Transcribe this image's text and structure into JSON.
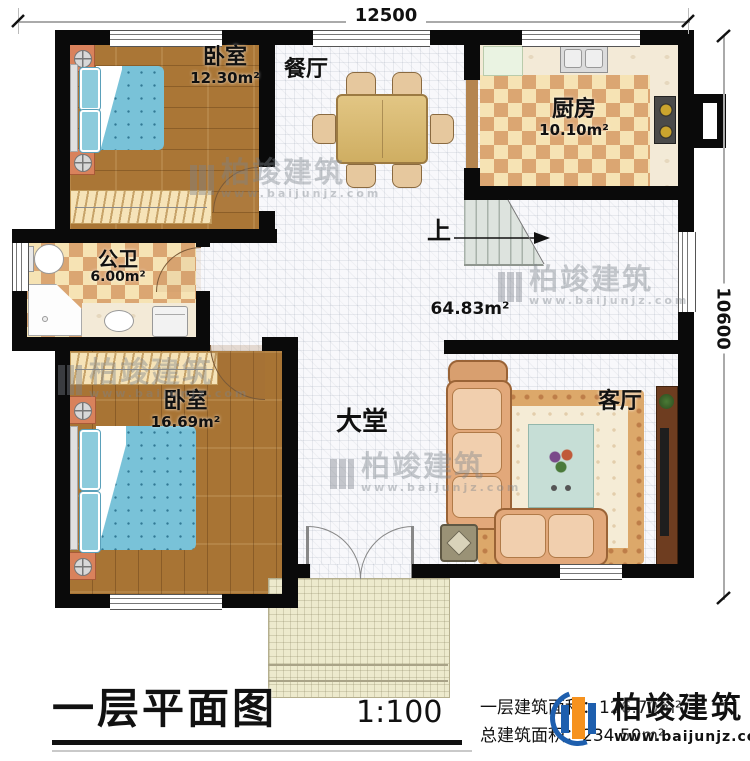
{
  "dimensions": {
    "width_label": "12500",
    "height_label": "10600"
  },
  "rooms": {
    "bedroom1": {
      "name": "卧室",
      "area": "12.30m²"
    },
    "dining": {
      "name": "餐厅"
    },
    "kitchen": {
      "name": "厨房",
      "area": "10.10m²"
    },
    "bathroom": {
      "name": "公卫",
      "area": "6.00m²"
    },
    "bedroom2": {
      "name": "卧室",
      "area": "16.69m²"
    },
    "hall": {
      "name": "大堂",
      "area": "64.83m²"
    },
    "living": {
      "name": "客厅"
    },
    "stairs": {
      "label": "上"
    }
  },
  "watermark": {
    "brand": "柏竣建筑",
    "site": "www.baijunjz.com"
  },
  "footer": {
    "title": "一层平面图",
    "scale": "1:100",
    "area_first_floor": "一层建筑面积：126.70m²",
    "area_total": "总建筑面积：234.50m²",
    "brand": "柏竣建筑",
    "site": "www.baijunjz.com"
  },
  "colors": {
    "wall": "#0a0a0a",
    "logo_blue": "#1e5fae",
    "logo_orange": "#f6921e"
  }
}
